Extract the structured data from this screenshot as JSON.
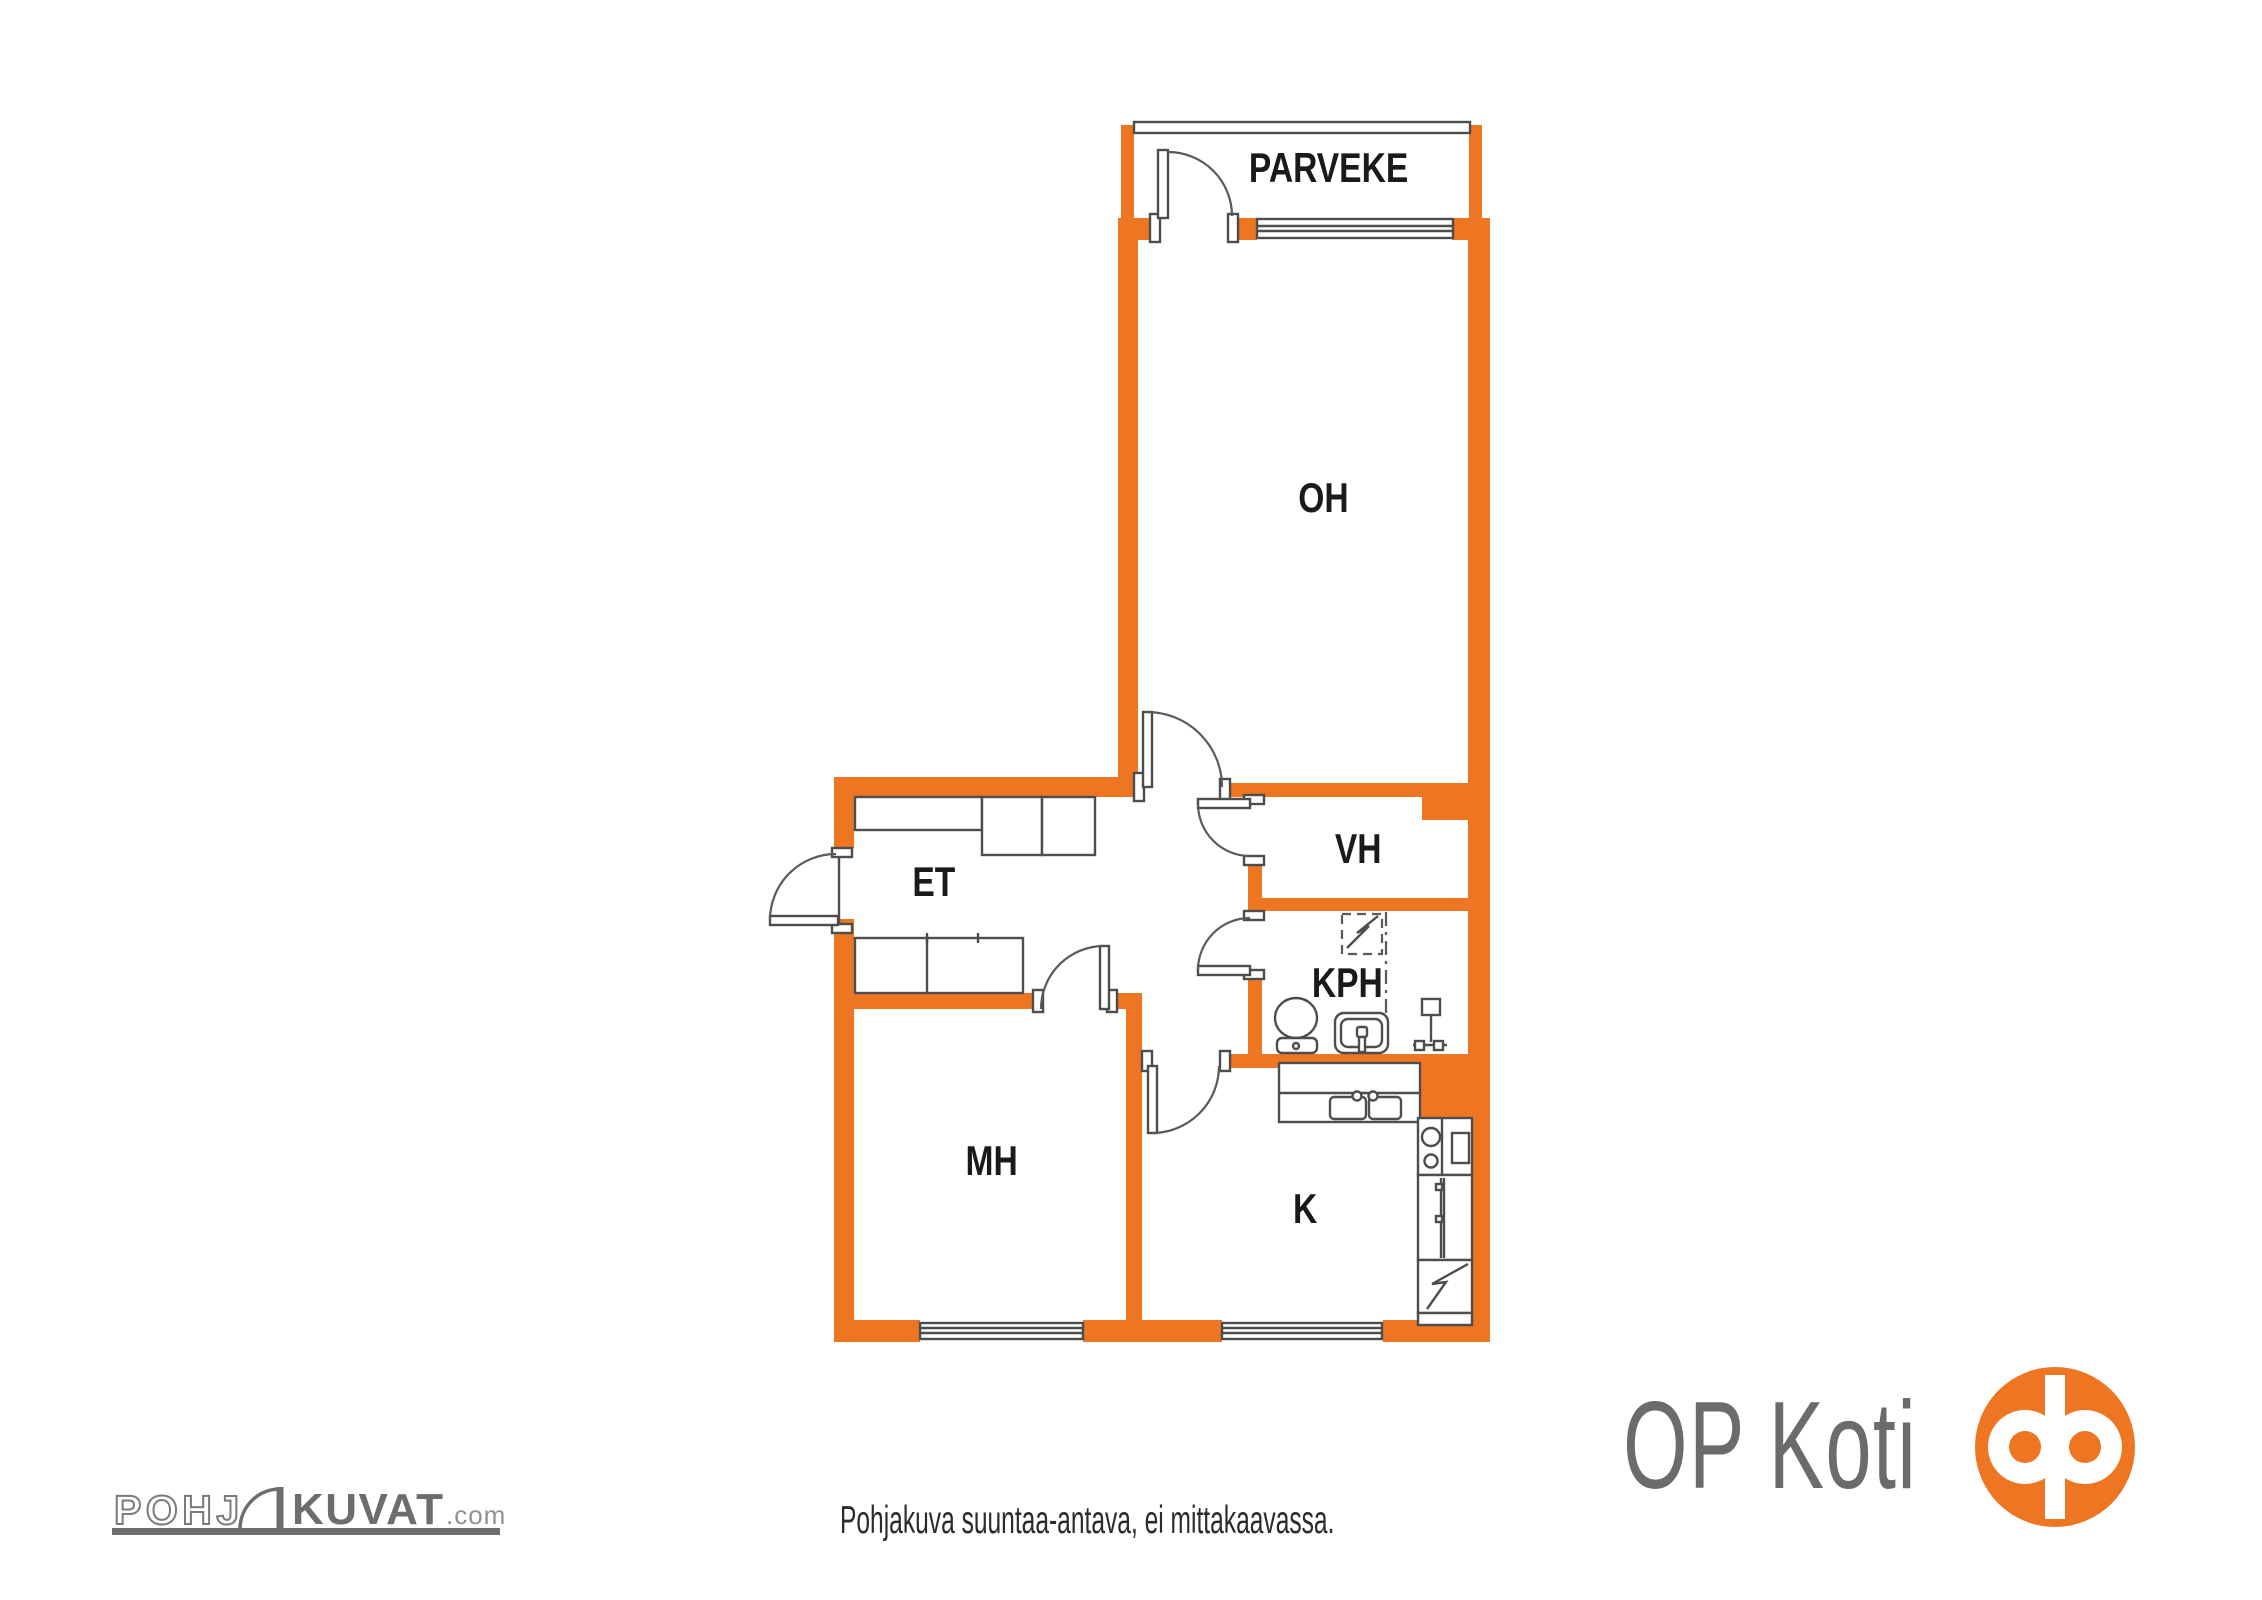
{
  "floorplan": {
    "rooms": {
      "parveke": {
        "label": "PARVEKE"
      },
      "oh": {
        "label": "OH"
      },
      "vh": {
        "label": "VH"
      },
      "et": {
        "label": "ET"
      },
      "kph": {
        "label": "KPH"
      },
      "mh": {
        "label": "MH"
      },
      "k": {
        "label": "K"
      }
    }
  },
  "footer": {
    "disclaimer": "Pohjakuva suuntaa-antava, ei mittakaavassa.",
    "pohjakuvat_logo": {
      "part1": "POHJ",
      "part2": "KUVAT",
      "suffix": ".com"
    },
    "op_logo_text": "OP Koti"
  },
  "colors": {
    "wall_orange": "#EE7623",
    "line_gray": "#4D4D4D",
    "text_black": "#1A1A1A",
    "logo_gray": "#6D6D6D",
    "logo_light_gray": "#919191",
    "op_orange": "#EE7623"
  }
}
